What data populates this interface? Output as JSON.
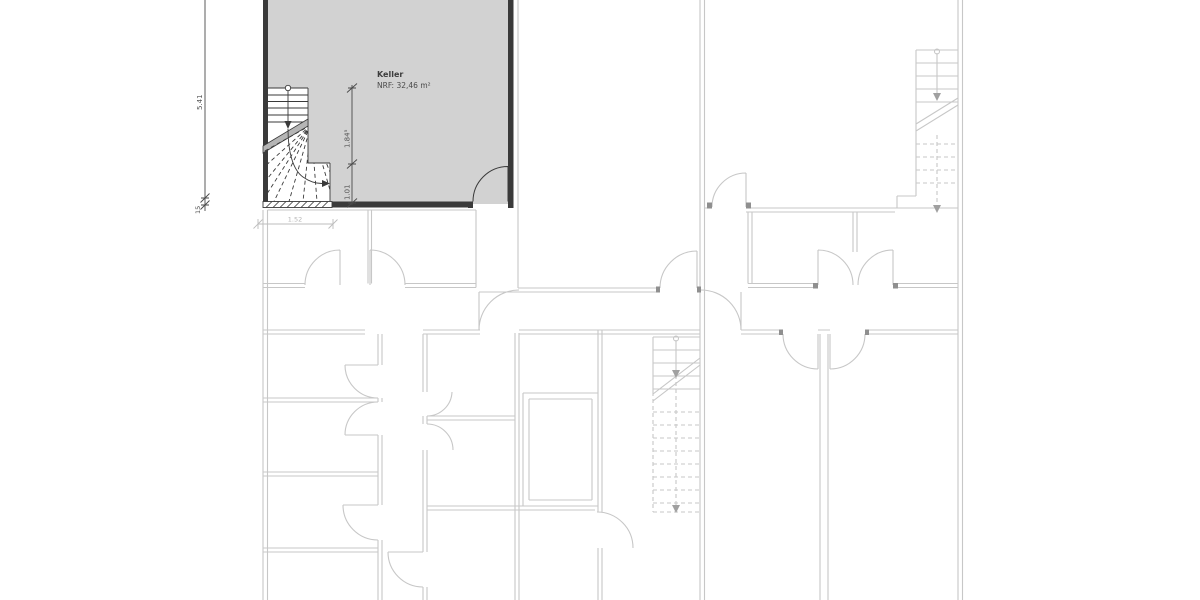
{
  "room": {
    "name": "Keller",
    "area_label": "NRF: 32,46 m²"
  },
  "dimensions": {
    "height_total": "5.41",
    "wall_thickness": "15",
    "stair_length": "1.84⁵",
    "stair_exit": "1.01",
    "room_width": "1.52"
  },
  "colors": {
    "background": "#ffffff",
    "room_fill": "#d2d2d2",
    "wall_dark": "#3a3a3a",
    "stair_cut_band": "#b5b5b5",
    "plan_light": "#c7c7c7",
    "jamb_medium": "#8f8f8f",
    "dimension": "#4a4a4a",
    "dimension_light": "#bdbdbd",
    "arrow_light": "#a0a0a0"
  }
}
